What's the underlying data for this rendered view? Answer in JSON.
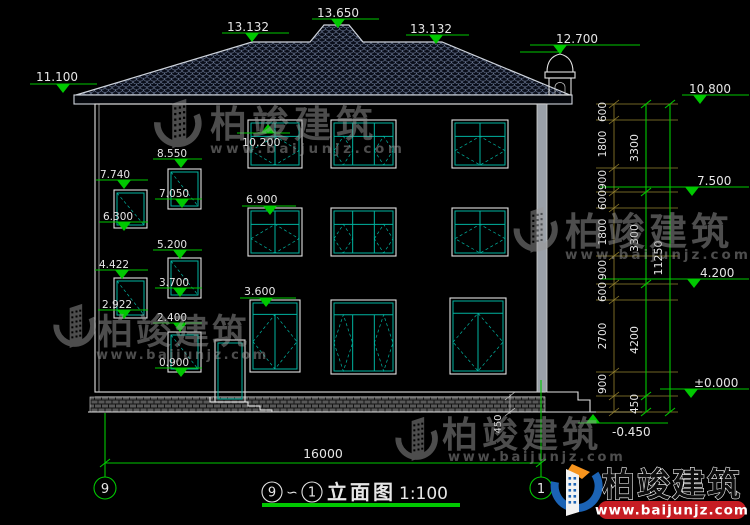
{
  "drawing": {
    "elevation_marks": {
      "left_eave": "11.100",
      "ridge_left": "13.132",
      "ridge_peak": "13.650",
      "ridge_right": "13.132",
      "turret": "12.700",
      "right_eave": "10.800",
      "right_f3": "7.500",
      "right_f2": "4.200",
      "right_zero": "±0.000",
      "right_ground": "-0.450",
      "win_f3": "10.200",
      "win_f2": "6.900",
      "win_f1": "3.600",
      "stair": [
        "8.550",
        "7.740",
        "7.050",
        "6.300",
        "5.200",
        "4.422",
        "3.700",
        "2.922",
        "2.400",
        "0.900"
      ]
    },
    "dims": {
      "right_small": [
        "600",
        "1800",
        "900",
        "600",
        "1800",
        "900",
        "600",
        "2700",
        "900"
      ],
      "right_floors": [
        "3300",
        "3300",
        "4200"
      ],
      "right_floor_base": "450",
      "right_total": "11250",
      "bottom_width": "16000",
      "wall_step": "450"
    },
    "axes": {
      "left": "9",
      "right": "1"
    },
    "title": {
      "from": "9",
      "tilde": "∽",
      "to": "1",
      "text": "立面图",
      "scale": "1:100"
    }
  },
  "watermark": {
    "brand": "柏竣建筑",
    "url": "www.baijunjz.com"
  },
  "logo": {
    "brand": "柏竣建筑",
    "url": "www.baijunjz.com"
  },
  "colors": {
    "green": "#00c800",
    "teal": "#00b3a0",
    "olive": "#97842f",
    "white": "#e6e6e6",
    "red": "#c61d23",
    "blue": "#1b63b5",
    "orange": "#f7941d",
    "gray": "#9a9a9a"
  }
}
